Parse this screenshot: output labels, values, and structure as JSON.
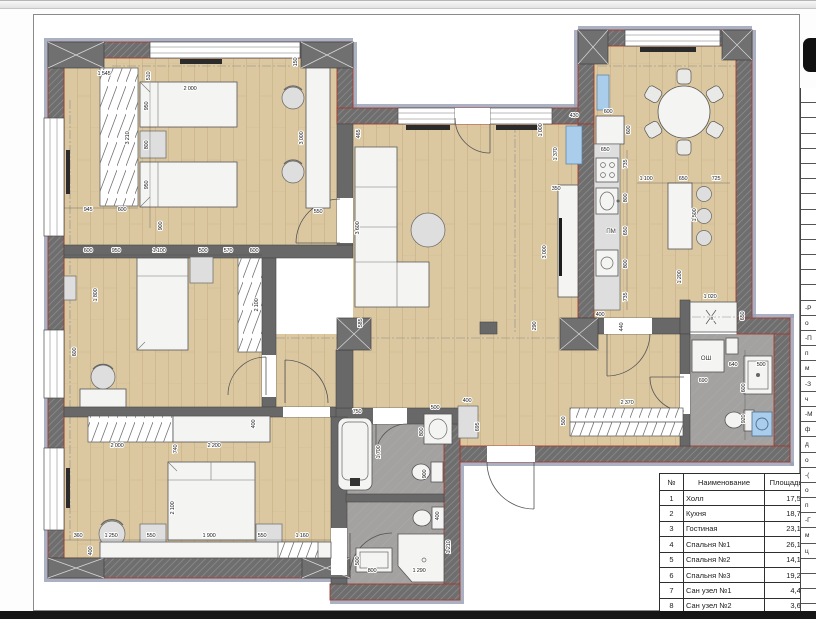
{
  "legend_table": {
    "headers": {
      "num": "№",
      "name": "Наименование",
      "area": "Площадь"
    },
    "rows": [
      [
        "1",
        "Холл",
        "17,58"
      ],
      [
        "2",
        "Кухня",
        "18,74"
      ],
      [
        "3",
        "Гостиная",
        "23,10"
      ],
      [
        "4",
        "Спальня №1",
        "26,19"
      ],
      [
        "5",
        "Спальня №2",
        "14,15"
      ],
      [
        "6",
        "Спальня №3",
        "19,23"
      ],
      [
        "7",
        "Сан узел №1",
        "4,44"
      ],
      [
        "8",
        "Сан узел №2",
        "3,65"
      ]
    ]
  },
  "edge_strip": {
    "fragments": [
      "-Р",
      "о",
      "-П",
      "п",
      "м",
      "-З",
      "ч",
      "-М",
      "ф",
      "д",
      "о",
      "-(",
      "о",
      "п",
      "-Г",
      "м",
      "ц"
    ]
  },
  "plan": {
    "colors": {
      "wood": "#dcc8a0",
      "wood_line": "#bfa67a",
      "wall": "#6e6e6e",
      "wall_red": "#a63a2e",
      "band": "#9aa3b8",
      "gray_floor": "#a4a2a0",
      "fixture": "#f4f4f2",
      "accent_blue": "#a9cdeb"
    },
    "labels": [
      {
        "t": "ПМ",
        "x": 611,
        "y": 233,
        "r": 0
      },
      {
        "t": "ОШ",
        "x": 706,
        "y": 360,
        "r": 0
      },
      {
        "t": "x",
        "x": 712,
        "y": 320,
        "r": 0
      }
    ],
    "dimensions": [
      {
        "t": "1 545",
        "x": 104,
        "y": 75,
        "r": 0
      },
      {
        "t": "510",
        "x": 150,
        "y": 76,
        "r": -90
      },
      {
        "t": "2 000",
        "x": 190,
        "y": 90,
        "r": 0
      },
      {
        "t": "950",
        "x": 148,
        "y": 106,
        "r": -90
      },
      {
        "t": "800",
        "x": 148,
        "y": 145,
        "r": -90
      },
      {
        "t": "950",
        "x": 148,
        "y": 185,
        "r": -90
      },
      {
        "t": "900",
        "x": 162,
        "y": 226,
        "r": -90
      },
      {
        "t": "3 210",
        "x": 129,
        "y": 138,
        "r": -90
      },
      {
        "t": "945",
        "x": 88,
        "y": 211,
        "r": 0
      },
      {
        "t": "600",
        "x": 122,
        "y": 211,
        "r": 0
      },
      {
        "t": "150",
        "x": 297,
        "y": 62,
        "r": -90
      },
      {
        "t": "3 000",
        "x": 303,
        "y": 138,
        "r": -90
      },
      {
        "t": "550",
        "x": 318,
        "y": 213,
        "r": 0
      },
      {
        "t": "465",
        "x": 360,
        "y": 134,
        "r": -90
      },
      {
        "t": "3 600",
        "x": 359,
        "y": 228,
        "r": -90
      },
      {
        "t": "585",
        "x": 362,
        "y": 323,
        "r": -90
      },
      {
        "t": "290",
        "x": 536,
        "y": 326,
        "r": -90
      },
      {
        "t": "3 000",
        "x": 546,
        "y": 252,
        "r": -90
      },
      {
        "t": "1 000",
        "x": 542,
        "y": 130,
        "r": -90
      },
      {
        "t": "600",
        "x": 88,
        "y": 252,
        "r": 0
      },
      {
        "t": "950",
        "x": 116,
        "y": 252,
        "r": 0
      },
      {
        "t": "1 100",
        "x": 159,
        "y": 252,
        "r": 0
      },
      {
        "t": "500",
        "x": 203,
        "y": 252,
        "r": 0
      },
      {
        "t": "570",
        "x": 228,
        "y": 252,
        "r": 0
      },
      {
        "t": "600",
        "x": 254,
        "y": 252,
        "r": 0
      },
      {
        "t": "1 800",
        "x": 97,
        "y": 295,
        "r": -90
      },
      {
        "t": "2 100",
        "x": 258,
        "y": 305,
        "r": -90
      },
      {
        "t": "600",
        "x": 76,
        "y": 352,
        "r": -90
      },
      {
        "t": "2 000",
        "x": 117,
        "y": 447,
        "r": 0
      },
      {
        "t": "2 200",
        "x": 214,
        "y": 447,
        "r": 0
      },
      {
        "t": "740",
        "x": 177,
        "y": 449,
        "r": -90
      },
      {
        "t": "400",
        "x": 255,
        "y": 424,
        "r": -90
      },
      {
        "t": "2 100",
        "x": 174,
        "y": 508,
        "r": -90
      },
      {
        "t": "360",
        "x": 78,
        "y": 537,
        "r": 0
      },
      {
        "t": "1 250",
        "x": 111,
        "y": 537,
        "r": 0
      },
      {
        "t": "550",
        "x": 151,
        "y": 537,
        "r": 0
      },
      {
        "t": "1 900",
        "x": 209,
        "y": 537,
        "r": 0
      },
      {
        "t": "550",
        "x": 262,
        "y": 537,
        "r": 0
      },
      {
        "t": "1 160",
        "x": 302,
        "y": 537,
        "r": 0
      },
      {
        "t": "400",
        "x": 92,
        "y": 551,
        "r": -90
      },
      {
        "t": "600",
        "x": 608,
        "y": 113,
        "r": 0
      },
      {
        "t": "600",
        "x": 630,
        "y": 130,
        "r": -90
      },
      {
        "t": "650",
        "x": 605,
        "y": 151,
        "r": 0
      },
      {
        "t": "735",
        "x": 627,
        "y": 164,
        "r": -90
      },
      {
        "t": "800",
        "x": 627,
        "y": 198,
        "r": -90
      },
      {
        "t": "650",
        "x": 627,
        "y": 231,
        "r": -90
      },
      {
        "t": "800",
        "x": 627,
        "y": 264,
        "r": -90
      },
      {
        "t": "735",
        "x": 627,
        "y": 297,
        "r": -90
      },
      {
        "t": "400",
        "x": 600,
        "y": 316,
        "r": 0
      },
      {
        "t": "430",
        "x": 574,
        "y": 117,
        "r": 0
      },
      {
        "t": "350",
        "x": 556,
        "y": 190,
        "r": 0
      },
      {
        "t": "1 370",
        "x": 557,
        "y": 154,
        "r": -90
      },
      {
        "t": "1 100",
        "x": 646,
        "y": 180,
        "r": 0
      },
      {
        "t": "650",
        "x": 683,
        "y": 180,
        "r": 0
      },
      {
        "t": "725",
        "x": 716,
        "y": 180,
        "r": 0
      },
      {
        "t": "1 500",
        "x": 696,
        "y": 215,
        "r": -90
      },
      {
        "t": "1 200",
        "x": 681,
        "y": 277,
        "r": -90
      },
      {
        "t": "1 020",
        "x": 710,
        "y": 298,
        "r": 0
      },
      {
        "t": "650",
        "x": 744,
        "y": 316,
        "r": -90
      },
      {
        "t": "440",
        "x": 623,
        "y": 327,
        "r": -90
      },
      {
        "t": "2 370",
        "x": 627,
        "y": 404,
        "r": 0
      },
      {
        "t": "500",
        "x": 565,
        "y": 421,
        "r": -90
      },
      {
        "t": "400",
        "x": 467,
        "y": 402,
        "r": 0
      },
      {
        "t": "695",
        "x": 479,
        "y": 427,
        "r": -90
      },
      {
        "t": "690",
        "x": 703,
        "y": 382,
        "r": 0
      },
      {
        "t": "640",
        "x": 733,
        "y": 366,
        "r": 0
      },
      {
        "t": "500",
        "x": 761,
        "y": 366,
        "r": 0
      },
      {
        "t": "600",
        "x": 745,
        "y": 388,
        "r": -90
      },
      {
        "t": "920",
        "x": 745,
        "y": 419,
        "r": -90
      },
      {
        "t": "750",
        "x": 357,
        "y": 413,
        "r": 0
      },
      {
        "t": "1 700",
        "x": 380,
        "y": 452,
        "r": -90
      },
      {
        "t": "500",
        "x": 435,
        "y": 409,
        "r": 0
      },
      {
        "t": "800",
        "x": 423,
        "y": 432,
        "r": -90
      },
      {
        "t": "900",
        "x": 426,
        "y": 474,
        "r": -90
      },
      {
        "t": "500",
        "x": 359,
        "y": 561,
        "r": -90
      },
      {
        "t": "800",
        "x": 372,
        "y": 572,
        "r": 0
      },
      {
        "t": "1 290",
        "x": 419,
        "y": 572,
        "r": 0
      },
      {
        "t": "1 210",
        "x": 450,
        "y": 547,
        "r": -90
      },
      {
        "t": "400",
        "x": 439,
        "y": 516,
        "r": -90
      }
    ]
  }
}
